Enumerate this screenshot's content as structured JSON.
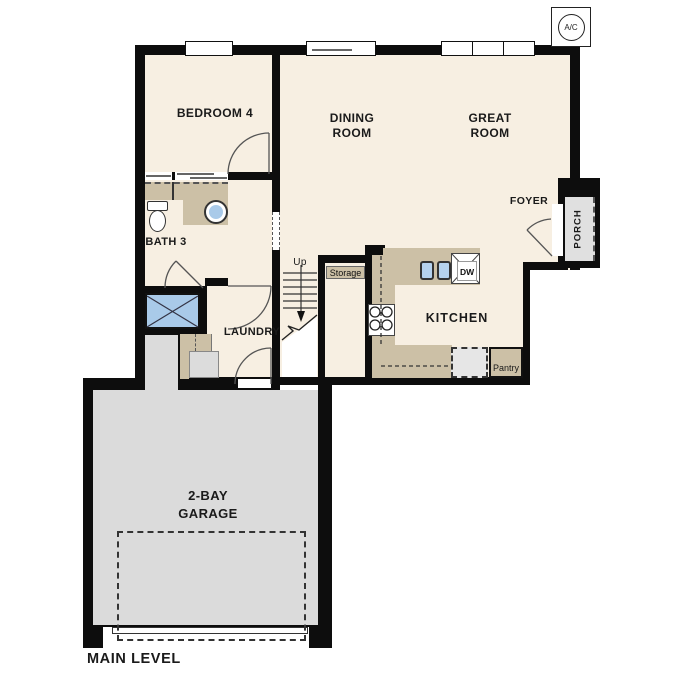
{
  "title": "MAIN LEVEL",
  "rooms": {
    "bedroom4": {
      "label": "BEDROOM 4"
    },
    "dining": {
      "label": "DINING ROOM"
    },
    "great": {
      "label": "GREAT ROOM"
    },
    "bath3": {
      "label": "BATH 3"
    },
    "laundry": {
      "label": "LAUNDRY"
    },
    "kitchen": {
      "label": "KITCHEN"
    },
    "foyer": {
      "label": "FOYER"
    },
    "porch": {
      "label": "PORCH"
    },
    "garage": {
      "label": "2-BAY GARAGE"
    },
    "storage": {
      "label": "Storage"
    },
    "pantry": {
      "label": "Pantry"
    }
  },
  "fixtures": {
    "dishwasher_label": "DW",
    "stairs_direction": "Up",
    "ac_label": "A/C"
  },
  "colors": {
    "wall": "#0d0d0d",
    "floor": "#f7efe2",
    "cabinet": "#ccc0a6",
    "garage": "#dbdbdb",
    "porch": "#e0e0e0",
    "fixture_blue": "#a9cae9"
  }
}
